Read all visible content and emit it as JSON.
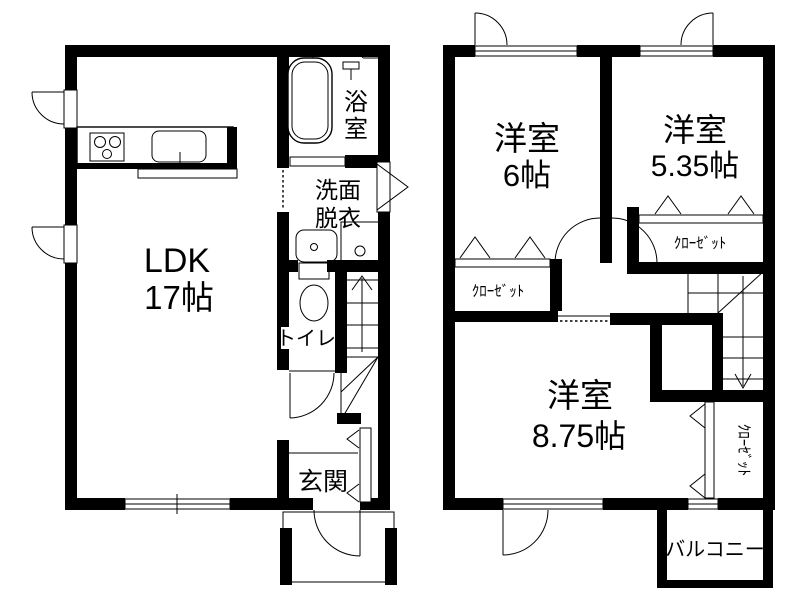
{
  "colors": {
    "wall": "#000000",
    "line": "#000000",
    "background": "#ffffff",
    "text": "#000000"
  },
  "floor1": {
    "ldk": {
      "line1": "LDK",
      "line2": "17帖"
    },
    "bath": {
      "line1": "浴",
      "line2": "室"
    },
    "washroom": {
      "line1": "洗面",
      "line2": "脱衣"
    },
    "toilet": {
      "label": "トイレ"
    },
    "entrance": {
      "label": "玄関"
    }
  },
  "floor2": {
    "bedroom6": {
      "line1": "洋室",
      "line2": "6帖"
    },
    "bedroom535": {
      "line1": "洋室",
      "line2": "5.35帖"
    },
    "bedroom875": {
      "line1": "洋室",
      "line2": "8.75帖"
    },
    "closet6": {
      "label": "ｸﾛｰｾﾞｯﾄ"
    },
    "closet535": {
      "label": "ｸﾛｰｾﾞｯﾄ"
    },
    "closet875": {
      "label": "ｸﾛｰｾﾞｯﾄ"
    },
    "balcony": {
      "label": "バルコニー"
    }
  }
}
